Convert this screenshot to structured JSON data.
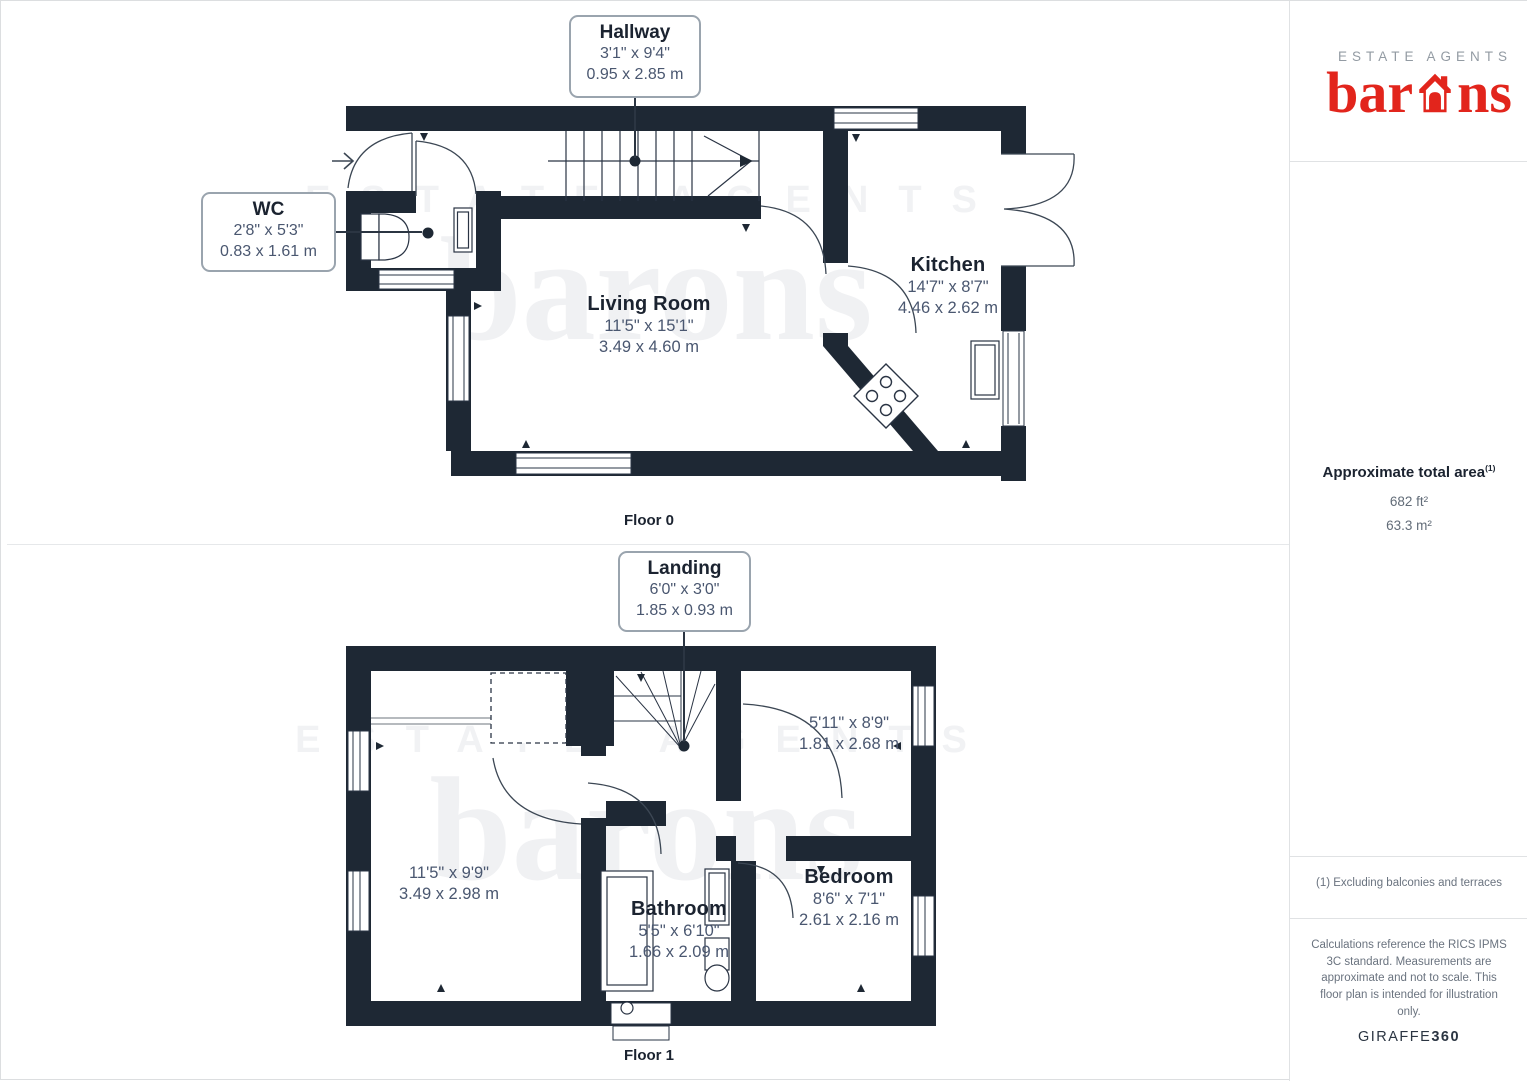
{
  "branding": {
    "tagline": "ESTATE AGENTS",
    "brand_pre": "bar",
    "brand_post": "ns",
    "brand_color": "#e2251c"
  },
  "watermark": {
    "line1": "ESTATE AGENTS",
    "line2": "barons"
  },
  "floor0": {
    "label": "Floor 0",
    "hallway": {
      "name": "Hallway",
      "imperial": "3'1\" x 9'4\"",
      "metric": "0.95 x 2.85 m"
    },
    "wc": {
      "name": "WC",
      "imperial": "2'8\" x 5'3\"",
      "metric": "0.83 x 1.61 m"
    },
    "living": {
      "name": "Living Room",
      "imperial": "11'5\" x 15'1\"",
      "metric": "3.49 x 4.60 m"
    },
    "kitchen": {
      "name": "Kitchen",
      "imperial": "14'7\" x 8'7\"",
      "metric": "4.46 x 2.62 m"
    }
  },
  "floor1": {
    "label": "Floor 1",
    "landing": {
      "name": "Landing",
      "imperial": "6'0\" x 3'0\"",
      "metric": "1.85 x 0.93 m"
    },
    "room_a": {
      "name": "",
      "imperial": "5'11\" x 8'9\"",
      "metric": "1.81 x 2.68 m"
    },
    "room_b": {
      "name": "",
      "imperial": "11'5\" x 9'9\"",
      "metric": "3.49 x 2.98 m"
    },
    "bathroom": {
      "name": "Bathroom",
      "imperial": "5'5\" x 6'10\"",
      "metric": "1.66 x 2.09 m"
    },
    "bedroom": {
      "name": "Bedroom",
      "imperial": "8'6\" x 7'1\"",
      "metric": "2.61 x 2.16 m"
    }
  },
  "sidebar": {
    "total_area_label": "Approximate total area",
    "total_area_sup": "(1)",
    "area_imperial": "682 ft²",
    "area_metric": "63.3 m²",
    "footnote": "(1) Excluding balconies and terraces",
    "disclaimer": "Calculations reference the RICS IPMS 3C standard. Measurements are approximate and not to scale. This floor plan is intended for illustration only.",
    "provider_pre": "GIRAFFE",
    "provider_post": "360"
  }
}
